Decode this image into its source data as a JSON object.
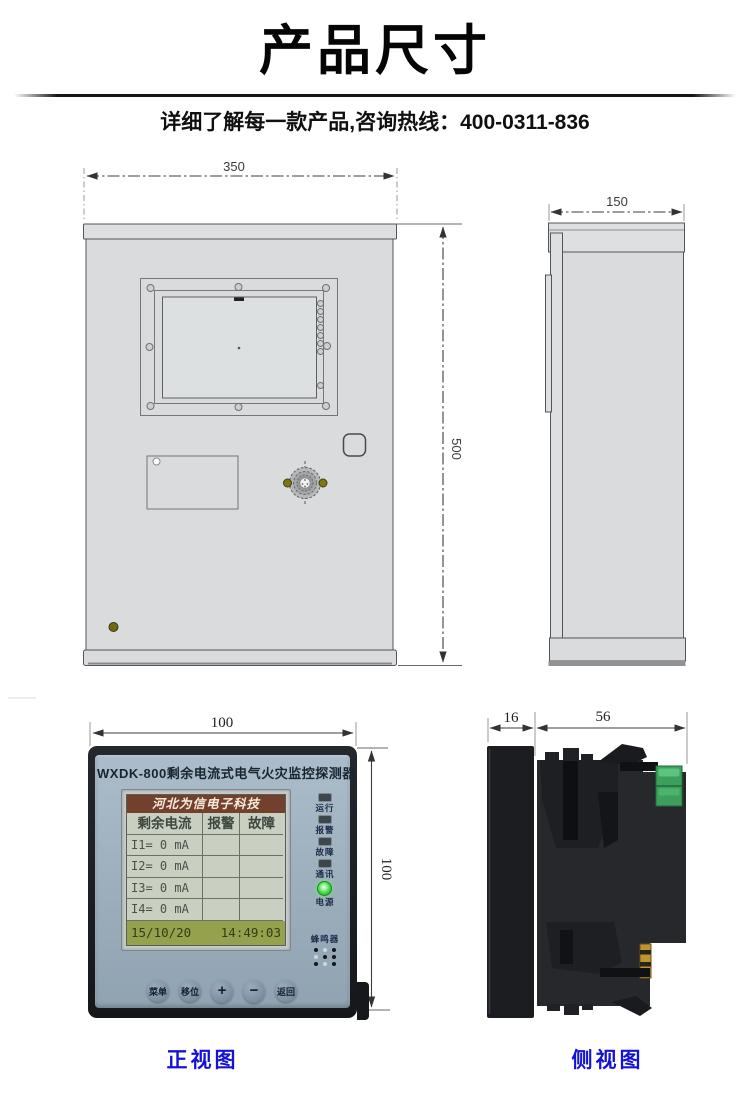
{
  "header": {
    "title": "产品尺寸",
    "subtitle": "详细了解每一款产品,咨询热线：400-0311-836"
  },
  "cabinet": {
    "front_width_mm": "350",
    "front_height_mm": "500",
    "side_depth_mm": "150"
  },
  "detector": {
    "front_width_mm": "100",
    "front_height_mm": "100",
    "side_bezel_mm": "16",
    "side_depth_mm": "56",
    "title": "WXDK-800剩余电流式电气火灾监控探测器",
    "lcd": {
      "brand": "河北为信电子科技",
      "columns": [
        "剩余电流",
        "报警",
        "故障"
      ],
      "rows": [
        [
          "I1= 0 mA",
          "",
          ""
        ],
        [
          "I2= 0 mA",
          "",
          ""
        ],
        [
          "I3= 0 mA",
          "",
          ""
        ],
        [
          "I4= 0 mA",
          "",
          ""
        ]
      ],
      "date": "15/10/20",
      "time": "14:49:03"
    },
    "leds": [
      {
        "label": "运行",
        "on": false
      },
      {
        "label": "报警",
        "on": false
      },
      {
        "label": "故障",
        "on": false
      },
      {
        "label": "通讯",
        "on": false
      },
      {
        "label": "电源",
        "on": true
      }
    ],
    "buzzer_label": "蜂鸣器",
    "buttons": [
      "菜单",
      "移位",
      "+",
      "−",
      "返回"
    ]
  },
  "captions": {
    "front_view": "正视图",
    "side_view": "侧视图"
  },
  "colors": {
    "caption_blue": "#1412d6",
    "panel_blue": "#9cafbc",
    "lcd_background": "#c9cfc1",
    "lcd_header_brown": "#74402e",
    "lcd_footer_olive": "#96a14d",
    "led_green": "#52e852",
    "terminal_green": "#3ca05c",
    "pin_gold": "#bd9430",
    "cabinet_gray": "#d9dbdc"
  }
}
